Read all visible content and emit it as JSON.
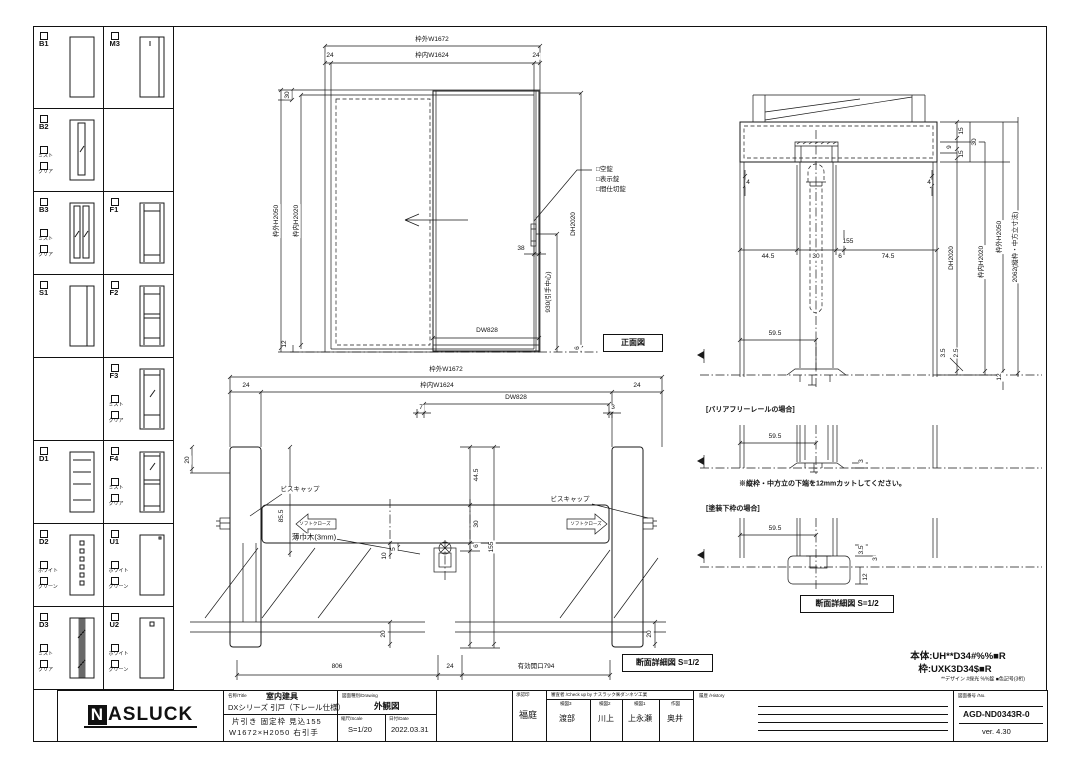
{
  "meta": {
    "line_color": "#1a1a1a",
    "background": "#ffffff"
  },
  "sidebar": {
    "rows": [
      {
        "cells": [
          {
            "code": "B1",
            "options": []
          },
          {
            "code": "M3",
            "options": []
          }
        ]
      },
      {
        "cells": [
          {
            "code": "B2",
            "options": [
              "ミスト",
              "クリア"
            ]
          },
          null
        ]
      },
      {
        "cells": [
          {
            "code": "B3",
            "options": [
              "ミスト",
              "クリア"
            ]
          },
          {
            "code": "F1",
            "options": []
          }
        ]
      },
      {
        "cells": [
          {
            "code": "S1",
            "options": []
          },
          {
            "code": "F2",
            "options": []
          }
        ]
      },
      {
        "cells": [
          null,
          {
            "code": "F3",
            "options": [
              "ミスト",
              "クリア"
            ]
          }
        ]
      },
      {
        "cells": [
          {
            "code": "D1",
            "options": []
          },
          {
            "code": "F4",
            "options": [
              "ミスト",
              "クリア"
            ]
          }
        ]
      },
      {
        "cells": [
          {
            "code": "D2",
            "options": [
              "ホワイト",
              "グリーン"
            ]
          },
          {
            "code": "U1",
            "options": [
              "ホワイト",
              "グリーン"
            ]
          }
        ]
      },
      {
        "cells": [
          {
            "code": "D3",
            "options": [
              "ミスト",
              "クリア"
            ]
          },
          {
            "code": "U2",
            "options": [
              "ホワイト",
              "グリーン"
            ]
          }
        ]
      }
    ]
  },
  "front_view": {
    "dim_w_outer": "枠外W1672",
    "dim_24_left": "24",
    "dim_w_inner": "枠内W1624",
    "dim_24_right": "24",
    "dim_30": "30",
    "dim_h_outer": "枠外H2050",
    "dim_h_inner": "枠内H2020",
    "dim_12": "12",
    "lock_1": "□空錠",
    "lock_2": "□表示錠",
    "lock_3": "□間仕切錠",
    "dim_dh": "DH2020",
    "dim_38": "38",
    "dim_930": "930(引手中心)",
    "dim_dw": "DW828",
    "dim_6": "6",
    "label": "正面図"
  },
  "plan_view": {
    "dim_w_outer": "枠外W1672",
    "dim_24_left": "24",
    "dim_w_inner": "枠内W1624",
    "dim_24_right": "24",
    "dim_7": "7",
    "dim_dw": "DW828",
    "dim_3": "3",
    "dim_20_top": "20",
    "dim_85_5": "85.5",
    "screw_cap_left": "ビスキャップ",
    "soft_close_left": "ソフトクローズ",
    "base_note": "薄巾木(3mm)",
    "dim_44_5": "44.5",
    "dim_30": "30",
    "dim_6": "6",
    "dim_155": "155",
    "dim_74_5": "74.5",
    "dim_10": "10",
    "dim_5": "5",
    "screw_cap_right": "ビスキャップ",
    "soft_close_right": "ソフトクローズ",
    "dim_20_left": "20",
    "dim_20_right": "20",
    "dim_806": "806",
    "dim_24_bottom": "24",
    "dim_opening": "有効開口794",
    "label": "断面詳細図 S=1/2"
  },
  "section_view": {
    "dim_4_left": "4",
    "dim_4_right": "4",
    "dim_15_a": "15",
    "dim_9": "9",
    "dim_15_b": "15",
    "dim_30_top": "30",
    "dim_155": "155",
    "dim_44_5": "44.5",
    "dim_30": "30",
    "dim_6": "6",
    "dim_74_5": "74.5",
    "dim_dh": "DH2020",
    "dim_h_inner": "枠内H2020",
    "dim_h_outer": "枠外H2050",
    "dim_2062": "2062(縦枠・中方立寸法)",
    "dim_59_5": "59.5",
    "dim_3_5": "3.5",
    "dim_2_5": "2.5",
    "dim_12": "12",
    "barrier_free_title": "[バリアフリーレールの場合]",
    "bf_59_5": "59.5",
    "bf_3": "3",
    "cut_note": "※縦枠・中方立の下端を12mmカットしてください。",
    "paint_title": "[塗装下枠の場合]",
    "pt_59_5": "59.5",
    "pt_3_5": "3.5",
    "pt_3": "3",
    "pt_12": "12",
    "label": "断面詳細図 S=1/2"
  },
  "spec": {
    "body": "本体:UH**D34#%%■R",
    "frame": "枠:UXK3D34$■R",
    "legend": "**デザイン #採光 %%錠 ■色記号(3桁)"
  },
  "title_block": {
    "logo_first": "N",
    "logo_rest": "ASLUCK",
    "title_header": "名称/Title",
    "category": "室内建具",
    "series": "DXシリーズ 引戸（下レール仕様）",
    "spec_line1": "片引き 固定枠 見込155",
    "spec_line2": "W1672×H2050 右引手",
    "drawing_header": "図面種別/Drawing",
    "drawing_type": "外観図",
    "scale_header": "縮尺/Scale",
    "scale": "S=1/20",
    "date_header": "日付/Date",
    "date": "2022.03.31",
    "approval_header": "承認印",
    "approver": "福庭",
    "check_header": "審査者 /Check up by ナスラック㈱ダンネツ工業",
    "checkers": [
      {
        "role": "検図3",
        "name": "渡部"
      },
      {
        "role": "検図2",
        "name": "川上"
      },
      {
        "role": "検図1",
        "name": "上永瀬"
      },
      {
        "role": "作図",
        "name": "奥井"
      }
    ],
    "history_header": "履歴 /History",
    "number_header": "図面番号 /No.",
    "drawing_number": "AGD-ND0343R-0",
    "version": "ver. 4.30"
  }
}
